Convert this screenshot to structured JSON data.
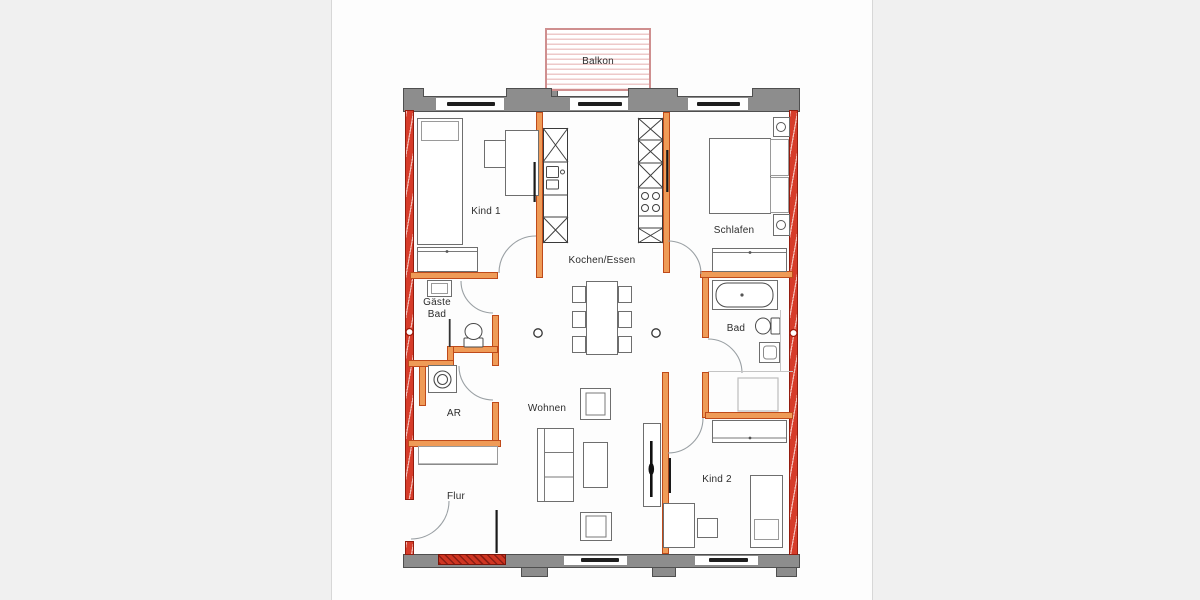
{
  "rooms": {
    "balkon": {
      "label": "Balkon"
    },
    "kind1": {
      "label": "Kind 1"
    },
    "kochen": {
      "label": "Kochen/Essen"
    },
    "schlafen": {
      "label": "Schlafen"
    },
    "gaeste_bad": {
      "line1": "Gäste",
      "line2": "Bad"
    },
    "bad": {
      "label": "Bad"
    },
    "ar": {
      "label": "AR"
    },
    "wohnen": {
      "label": "Wohnen"
    },
    "flur": {
      "label": "Flur"
    },
    "kind2": {
      "label": "Kind 2"
    }
  },
  "colors": {
    "exterior_wall_red": "#d63c2a",
    "interior_wall_orange": "#ef9b57",
    "masonry_wall_gray": "#8d8d8d",
    "balcony_stripe_pink": "#eec9c9",
    "window_glass_black": "#1e1e1e"
  }
}
